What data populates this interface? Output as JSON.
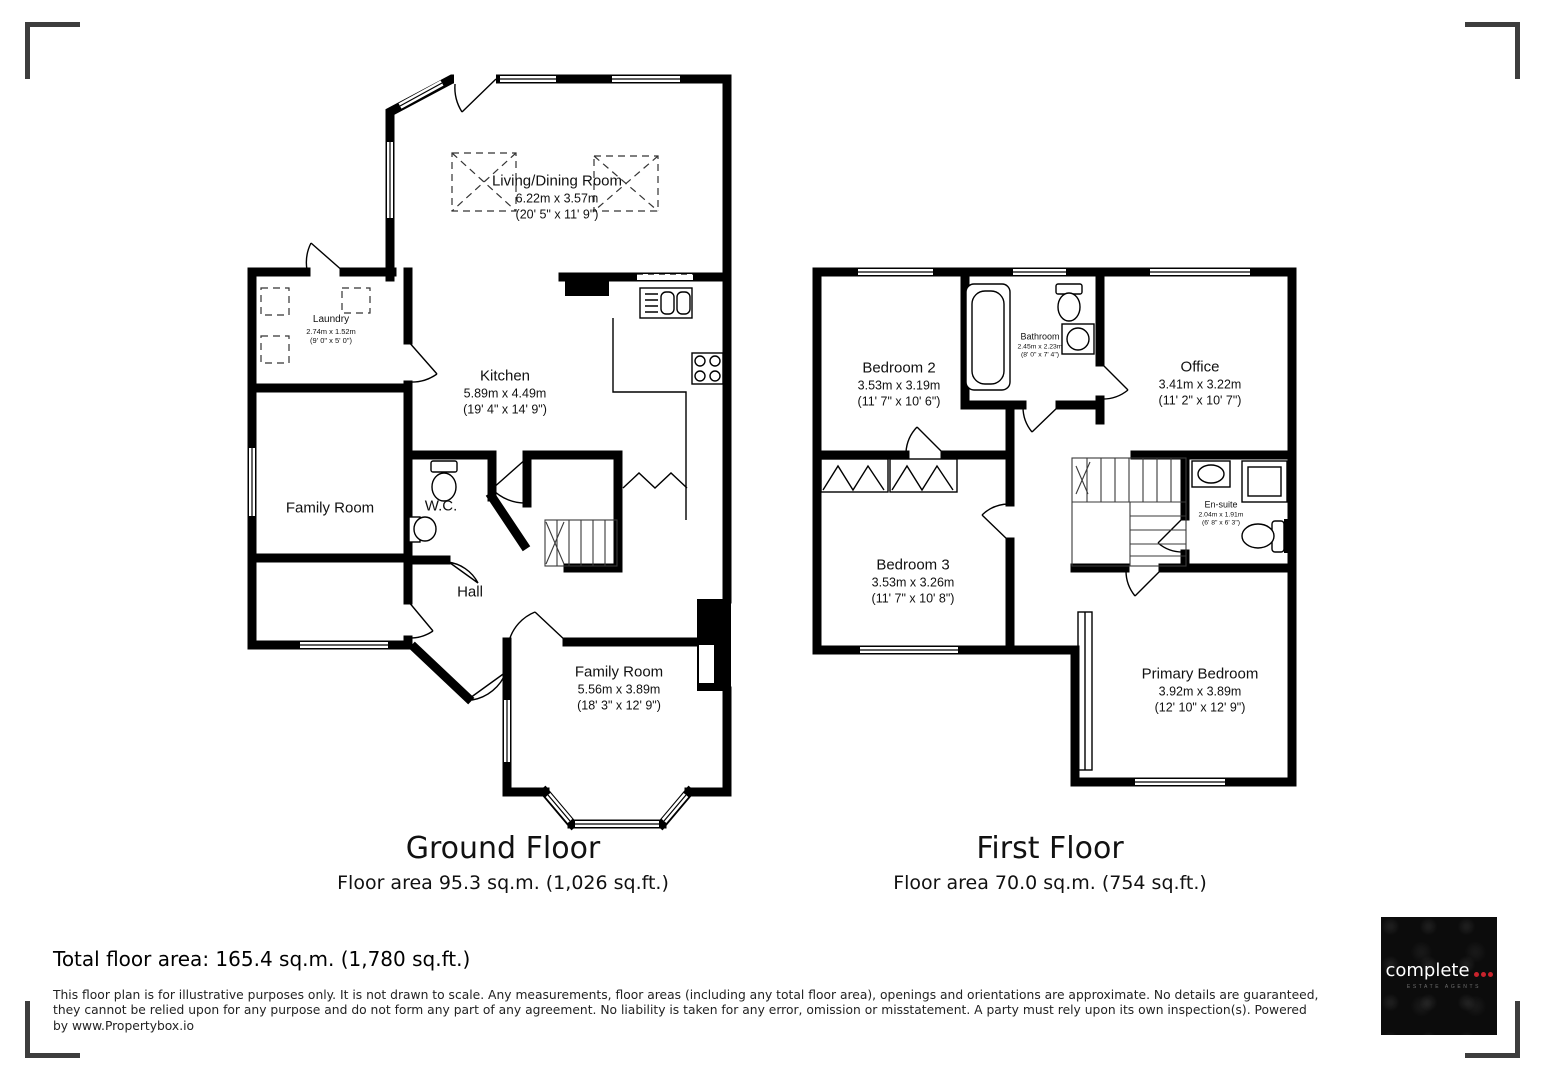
{
  "ground_floor": {
    "title": "Ground Floor",
    "area_label": "Floor area 95.3 sq.m. (1,026 sq.ft.)",
    "rooms": {
      "living_dining": {
        "name": "Living/Dining Room",
        "metric": "6.22m x 3.57m",
        "imperial": "(20' 5\" x 11' 9\")"
      },
      "laundry": {
        "name": "Laundry",
        "metric": "2.74m x 1.52m",
        "imperial": "(9' 0\" x 5' 0\")"
      },
      "kitchen": {
        "name": "Kitchen",
        "metric": "5.89m x 4.49m",
        "imperial": "(19' 4\" x 14' 9\")"
      },
      "family_room": {
        "name": "Family Room"
      },
      "wc": {
        "name": "W.C."
      },
      "hall": {
        "name": "Hall"
      },
      "family_room_2": {
        "name": "Family Room",
        "metric": "5.56m x 3.89m",
        "imperial": "(18' 3\" x 12' 9\")"
      }
    }
  },
  "first_floor": {
    "title": "First Floor",
    "area_label": "Floor area 70.0 sq.m. (754 sq.ft.)",
    "rooms": {
      "bedroom_2": {
        "name": "Bedroom 2",
        "metric": "3.53m x 3.19m",
        "imperial": "(11' 7\" x 10' 6\")"
      },
      "bathroom": {
        "name": "Bathroom",
        "metric": "2.45m x 2.23m",
        "imperial": "(8' 0\" x 7' 4\")"
      },
      "office": {
        "name": "Office",
        "metric": "3.41m x 3.22m",
        "imperial": "(11' 2\" x 10' 7\")"
      },
      "bedroom_3": {
        "name": "Bedroom 3",
        "metric": "3.53m x 3.26m",
        "imperial": "(11' 7\" x 10' 8\")"
      },
      "ensuite": {
        "name": "En-suite",
        "metric": "2.04m x 1.91m",
        "imperial": "(6' 8\" x 6' 3\")"
      },
      "primary_bedroom": {
        "name": "Primary Bedroom",
        "metric": "3.92m x 3.89m",
        "imperial": "(12' 10\" x 12' 9\")"
      }
    }
  },
  "footer": {
    "total_area": "Total floor area: 165.4 sq.m. (1,780 sq.ft.)",
    "disclaimer_lines": [
      "This floor plan is for illustrative purposes only. It is not drawn to scale. Any measurements, floor areas (including any total floor area), openings and orientations are approximate. No details are guaranteed,",
      "they cannot be relied upon for any purpose and do not form any part of any agreement. No liability is taken for any error, omission or misstatement. A party must rely upon its own inspection(s). Powered",
      "by www.Propertybox.io"
    ]
  },
  "logo": {
    "brand": "complete",
    "tagline": "ESTATE AGENTS",
    "dot_color": "#c8232c",
    "background": "#0c0c0c",
    "text_color": "#ffffff"
  }
}
